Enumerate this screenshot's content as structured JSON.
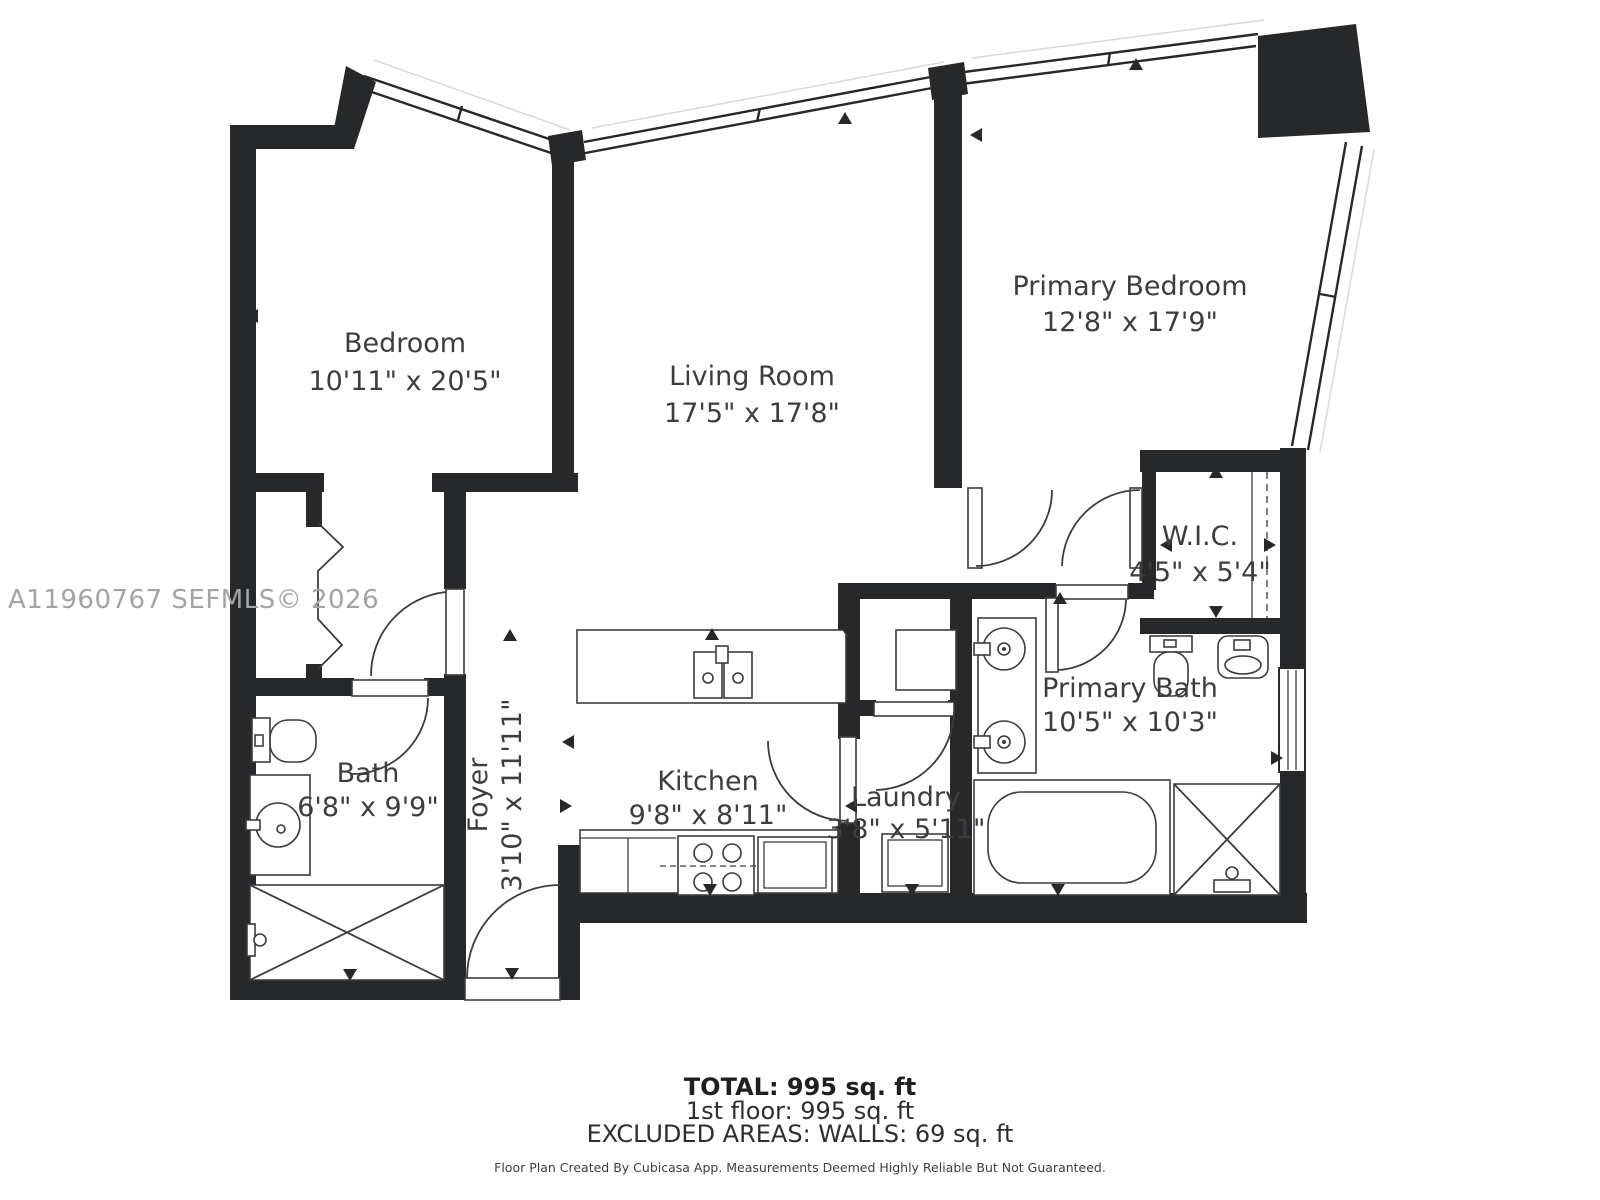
{
  "plan": {
    "watermark": "A11960767  SEFMLS© 2026",
    "rooms": [
      {
        "name": "Bedroom",
        "dims": "10'11\" x 20'5\""
      },
      {
        "name": "Living Room",
        "dims": "17'5\" x 17'8\""
      },
      {
        "name": "Primary Bedroom",
        "dims": "12'8\" x 17'9\""
      },
      {
        "name": "W.I.C.",
        "dims": "4'5\" x 5'4\""
      },
      {
        "name": "Primary Bath",
        "dims": "10'5\" x 10'3\""
      },
      {
        "name": "Bath",
        "dims": "6'8\" x 9'9\""
      },
      {
        "name": "Kitchen",
        "dims": "9'8\" x 8'11\""
      },
      {
        "name": "Laundry",
        "dims": "3'8\" x 5'11\""
      },
      {
        "name": "Foyer",
        "dims": "3'10\" x 11'11\""
      }
    ],
    "footer": {
      "total": "TOTAL: 995 sq. ft",
      "floor": "1st floor: 995 sq. ft",
      "excluded": "EXCLUDED AREAS: WALLS: 69 sq. ft",
      "disclaimer": "Floor Plan Created By Cubicasa App. Measurements Deemed Highly Reliable But Not Guaranteed."
    },
    "colors": {
      "wall": "#26282a",
      "line": "#3a3c3e",
      "watermark": "#a2a4a6"
    }
  }
}
